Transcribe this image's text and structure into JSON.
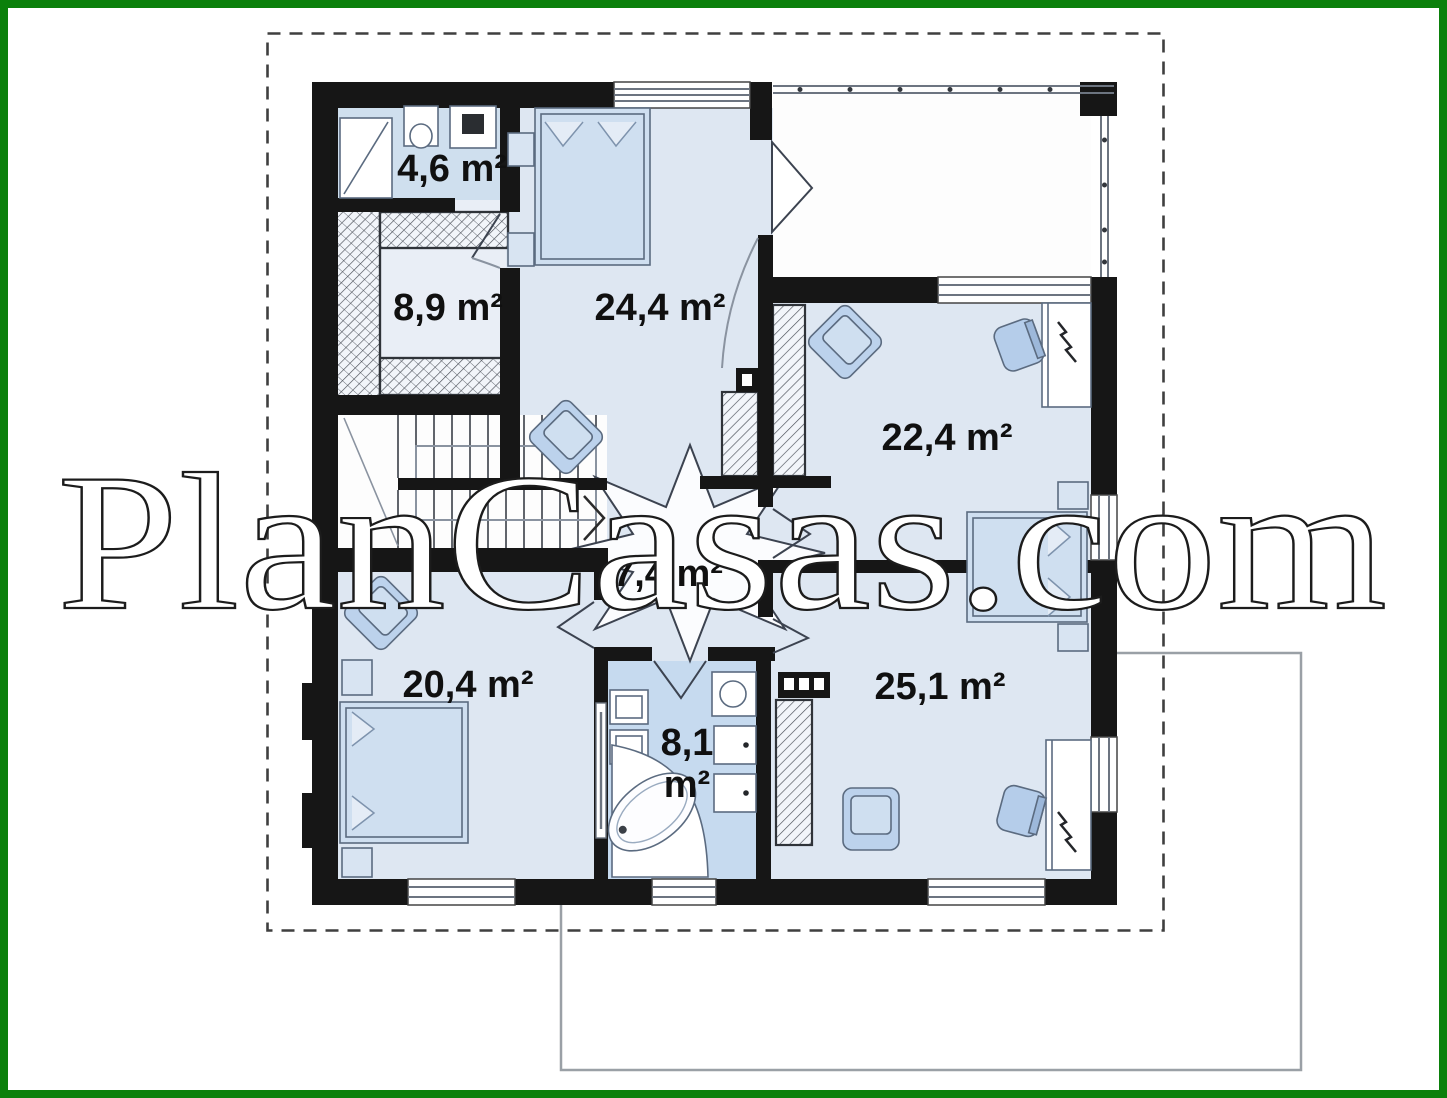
{
  "page": {
    "background_color": "#ffffff",
    "frame_color": "#0b800b",
    "plan_type": "floor-plan"
  },
  "watermark": {
    "text": "PlanCasas.com"
  },
  "plan": {
    "wall_color": "#161616",
    "floor_color": "#dee7f2",
    "bathroom_floor_color": "#c6daef",
    "rooms": [
      {
        "name": "bathroom-small",
        "area_label": "4,6 m²"
      },
      {
        "name": "wardrobe-room",
        "area_label": "8,9 m²"
      },
      {
        "name": "bedroom-top",
        "area_label": "24,4 m²"
      },
      {
        "name": "bedroom-right",
        "area_label": "22,4 m²"
      },
      {
        "name": "hallway",
        "area_label": "7,4 m²"
      },
      {
        "name": "bedroom-left",
        "area_label": "20,4 m²"
      },
      {
        "name": "bathroom-main",
        "area_label_line1": "8,1",
        "area_label_line2": "m²"
      },
      {
        "name": "bedroom-bottom",
        "area_label": "25,1 m²"
      }
    ]
  }
}
